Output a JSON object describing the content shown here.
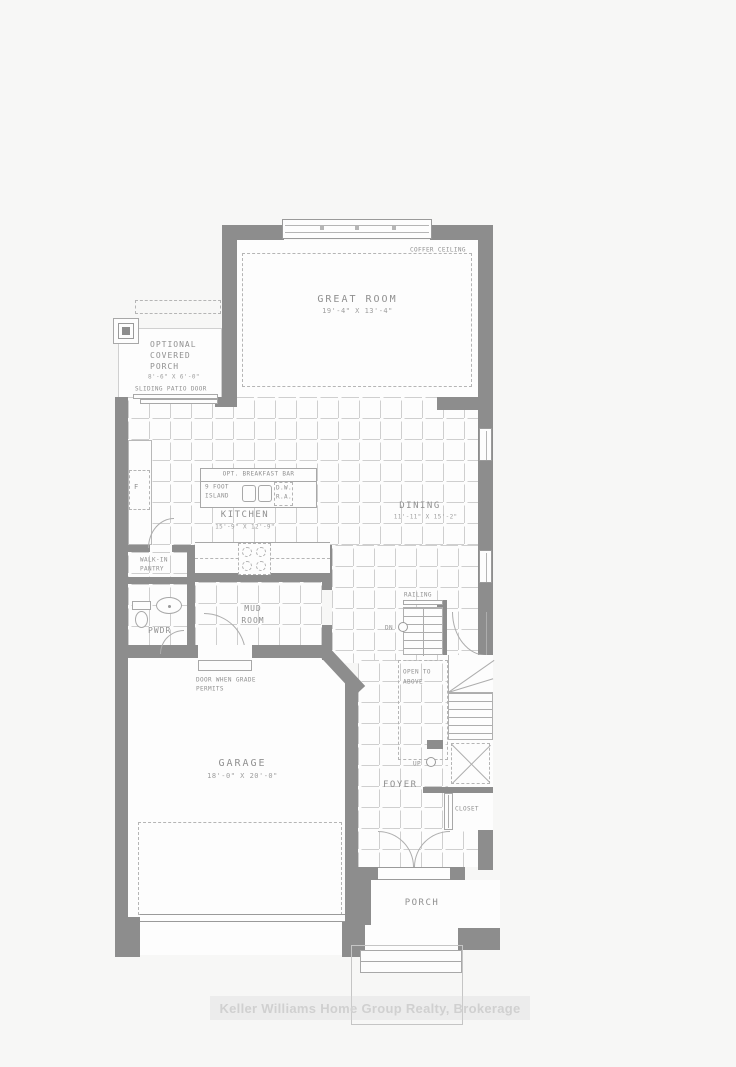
{
  "labels": {
    "coffer": "COFFER CEILING",
    "great_room": "GREAT ROOM",
    "great_room_dims": "19'-4\" X 13'-4\"",
    "optional": "OPTIONAL",
    "covered": "COVERED",
    "porch_opt": "PORCH",
    "porch_opt_dims": "8'-6\" X 6'-0\"",
    "sliding_door": "SLIDING PATIO DOOR",
    "kitchen": "KITCHEN",
    "kitchen_dims": "15'-9\" X 12'-9\"",
    "breakfast_bar": "OPT. BREAKFAST BAR",
    "island_l1": "9 FOOT",
    "island_l2": "ISLAND",
    "dw": "D.W.",
    "ra": "R.A.",
    "fridge": "F",
    "dining": "DINING",
    "dining_dims": "11'-11\" X 15'-2\"",
    "pantry_l1": "WALK-IN",
    "pantry_l2": "PANTRY",
    "pwdr": "PWDR",
    "mud_l1": "MUD",
    "mud_l2": "ROOM",
    "railing": "RAILING",
    "dn": "DN",
    "up": "UP",
    "open_l1": "OPEN TO",
    "open_l2": "ABOVE",
    "foyer": "FOYER",
    "closet": "CLOSET",
    "grade_l1": "DOOR WHEN GRADE",
    "grade_l2": "PERMITS",
    "garage": "GARAGE",
    "garage_dims": "18'-0\" X 20'-0\"",
    "porch": "PORCH"
  },
  "watermark": "Keller Williams Home Group Realty, Brokerage",
  "colors": {
    "wall": "#8d8d8d",
    "tile_line": "#cfcfcf",
    "text": "#909090",
    "thin_line": "#a8a8a8",
    "dash": "#b5b5b5",
    "watermark": "#d0d0d0",
    "background": "#f7f7f6",
    "floor": "#fdfdfd"
  }
}
